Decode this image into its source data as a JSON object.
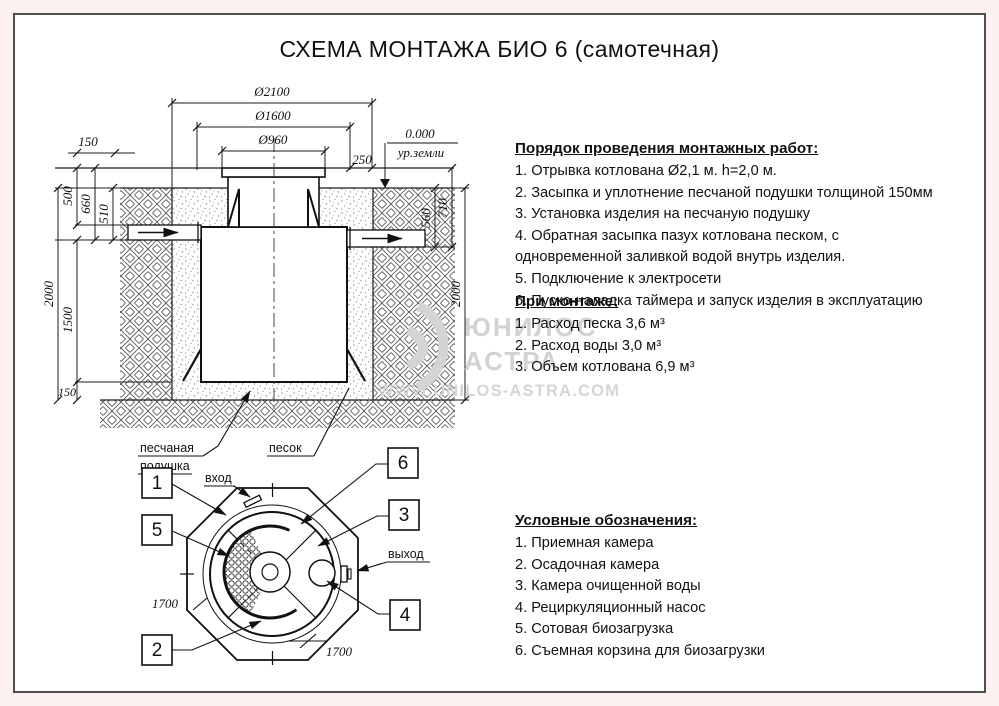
{
  "page": {
    "title": "СХЕМА МОНТАЖА БИО 6 (самотечная)"
  },
  "cross_section": {
    "dims": {
      "d2100": "Ø2100",
      "d1600": "Ø1600",
      "d960": "Ø960",
      "level": "0.000",
      "ground_level": "ур.земли",
      "d250": "250",
      "d150_top": "150",
      "d500": "500",
      "d660": "660",
      "d510": "510",
      "d2000_left": "2000",
      "d1500": "1500",
      "d150_bottom": "150",
      "d560": "560",
      "d710": "710",
      "d2000_right": "2000"
    },
    "labels": {
      "sand_cushion_line1": "песчаная",
      "sand_cushion_line2": "подушка",
      "sand": "песок"
    }
  },
  "top_view": {
    "callouts": [
      "1",
      "2",
      "3",
      "4",
      "5",
      "6"
    ],
    "labels": {
      "inlet": "вход",
      "outlet": "выход"
    },
    "dims": {
      "d1700_left": "1700",
      "d1700_bottom": "1700"
    }
  },
  "instructions": {
    "heading": "Порядок проведения монтажных работ:",
    "items": [
      "1. Отрывка котлована Ø2,1 м. h=2,0 м.",
      "2. Засыпка и уплотнение песчаной подушки толщиной 150мм",
      "3. Установка изделия на песчаную подушку",
      "4. Обратная засыпка пазух котлована песком, с одновременной заливкой водой внутрь изделия.",
      "5. Подключение к электросети",
      "6. Пуско-наладка таймера и запуск изделия в эксплуатацию"
    ]
  },
  "installation": {
    "heading": "При монтаже:",
    "items": [
      "1. Расход песка 3,6 м³",
      "2. Расход воды 3,0 м³",
      "3. Объем котлована 6,9 м³"
    ]
  },
  "legend": {
    "heading": "Условные обозначения:",
    "items": [
      "1. Приемная камера",
      "2. Осадочная камера",
      "3. Камера очищенной воды",
      "4. Рециркуляционный насос",
      "5. Сотовая биозагрузка",
      "6. Съемная корзина для биозагрузки"
    ]
  },
  "watermark": {
    "line1": "ЮНИЛОС",
    "line2": "АСТРА",
    "url": "WWW.UNILOS-ASTRA.COM"
  }
}
